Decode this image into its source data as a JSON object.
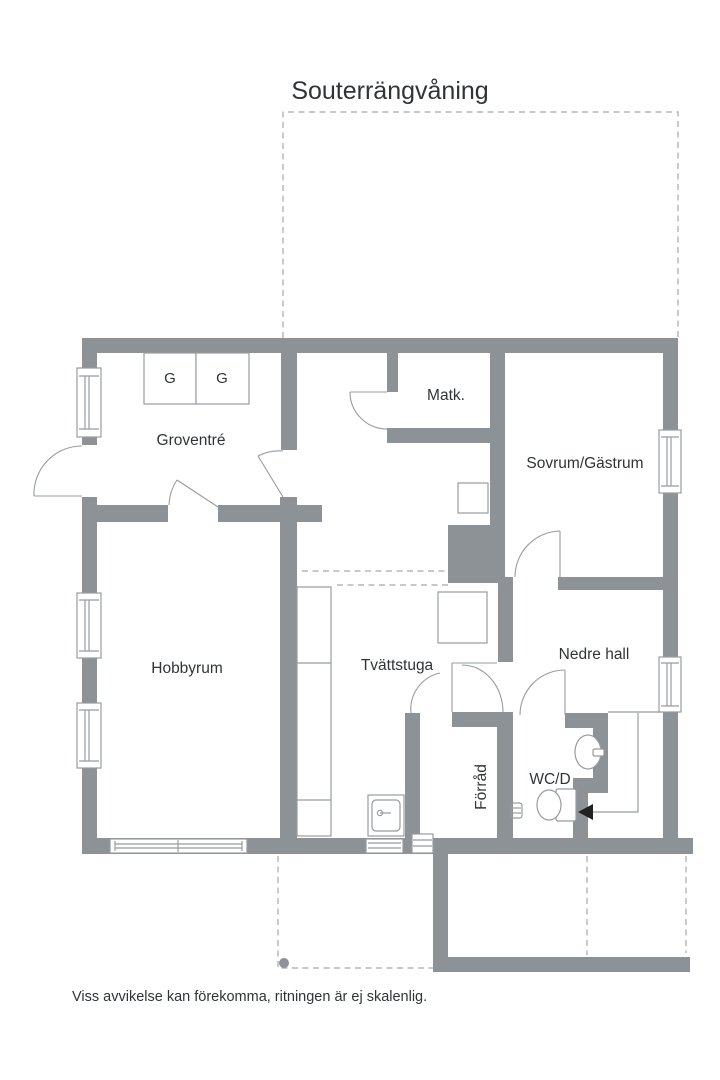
{
  "page": {
    "title": "Souterrängvåning",
    "disclaimer": "Viss avvikelse kan förekomma, ritningen är ej skalenlig."
  },
  "rooms": {
    "groventre": {
      "label": "Groventré"
    },
    "matk": {
      "label": "Matk."
    },
    "sovrum_gastrum": {
      "label": "Sovrum/Gästrum"
    },
    "hobbyrum": {
      "label": "Hobbyrum"
    },
    "tvattstuga": {
      "label": "Tvättstuga"
    },
    "nedre_hall": {
      "label": "Nedre hall"
    },
    "forrad": {
      "label": "Förråd"
    },
    "wc_d": {
      "label": "WC/D"
    }
  },
  "wardrobes": {
    "g1": "G",
    "g2": "G"
  },
  "colors": {
    "wall": "#8c9295",
    "line": "#979c9f",
    "dash": "#a3a8ab",
    "text": "#303436",
    "background": "#ffffff"
  }
}
